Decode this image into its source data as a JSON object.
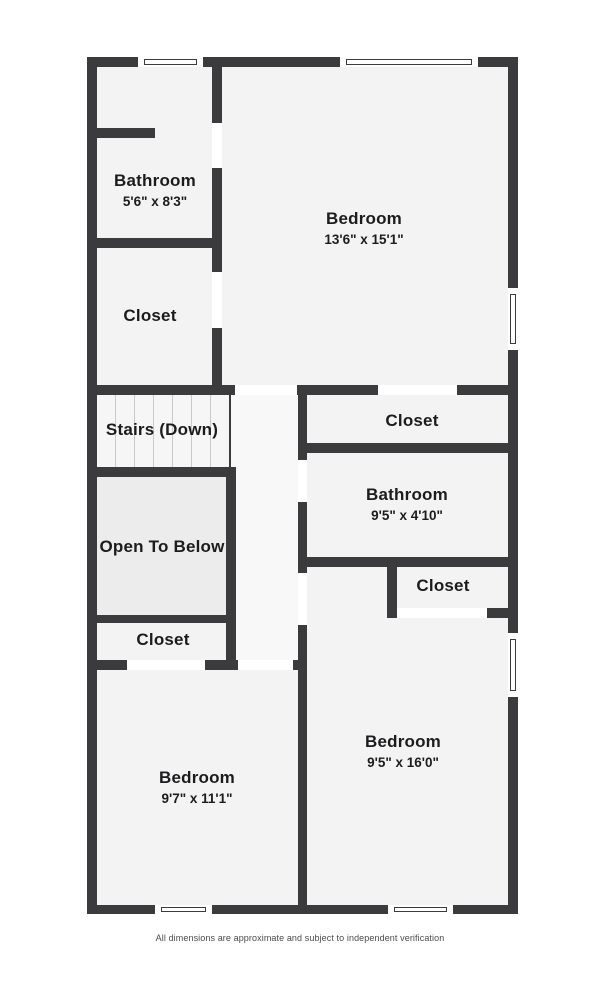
{
  "colors": {
    "wall": "#3b3b3e",
    "room": "#f3f3f3",
    "open_to_below": "#ececec",
    "hallway": "#f8f8f8",
    "background": "#ffffff"
  },
  "rooms": {
    "bathroom_upper": {
      "name": "Bathroom",
      "dims": "5'6\" x 8'3\""
    },
    "closet_upper_left": {
      "name": "Closet"
    },
    "bedroom_upper": {
      "name": "Bedroom",
      "dims": "13'6\" x 15'1\""
    },
    "stairs": {
      "name": "Stairs (Down)"
    },
    "open_to_below": {
      "name": "Open To Below"
    },
    "closet_mid_left": {
      "name": "Closet"
    },
    "closet_mid_right": {
      "name": "Closet"
    },
    "bathroom_mid": {
      "name": "Bathroom",
      "dims": "9'5\" x 4'10\""
    },
    "closet_lower_right": {
      "name": "Closet"
    },
    "bedroom_lower_right": {
      "name": "Bedroom",
      "dims": "9'5\" x 16'0\""
    },
    "bedroom_lower_left": {
      "name": "Bedroom",
      "dims": "9'7\" x 11'1\""
    }
  },
  "footer": {
    "disclaimer": "All dimensions are approximate and subject to independent verification"
  }
}
